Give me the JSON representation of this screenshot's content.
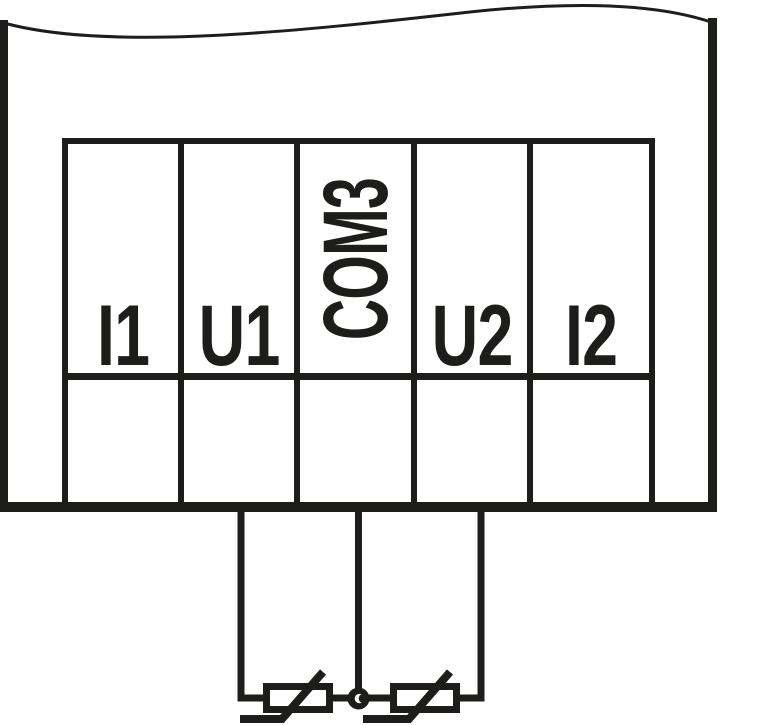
{
  "diagram": {
    "kind": "terminal-wiring-diagram",
    "description": "Partial view of a device (torn top edge) showing a 5-pole terminal block; two thermistor temperature sensors are wired externally between U1 and COM3 and between COM3 and U2, joined at a common junction dot under COM3.",
    "ink_color": "#1d1d1b",
    "background_color": "#ffffff"
  },
  "terminals": [
    {
      "label": "I1",
      "orientation": "horizontal",
      "wired": false
    },
    {
      "label": "U1",
      "orientation": "horizontal",
      "wired": true
    },
    {
      "label": "COM3",
      "orientation": "vertical-bottom-to-top",
      "wired": true
    },
    {
      "label": "U2",
      "orientation": "horizontal",
      "wired": true
    },
    {
      "label": "I2",
      "orientation": "horizontal",
      "wired": false
    }
  ],
  "sensors": [
    {
      "name": "thermistor-1",
      "symbol": "thermistor",
      "connected_between": [
        "U1",
        "COM3"
      ]
    },
    {
      "name": "thermistor-2",
      "symbol": "thermistor",
      "connected_between": [
        "COM3",
        "U2"
      ]
    }
  ],
  "junction": {
    "name": "common-junction",
    "at_terminal": "COM3"
  }
}
